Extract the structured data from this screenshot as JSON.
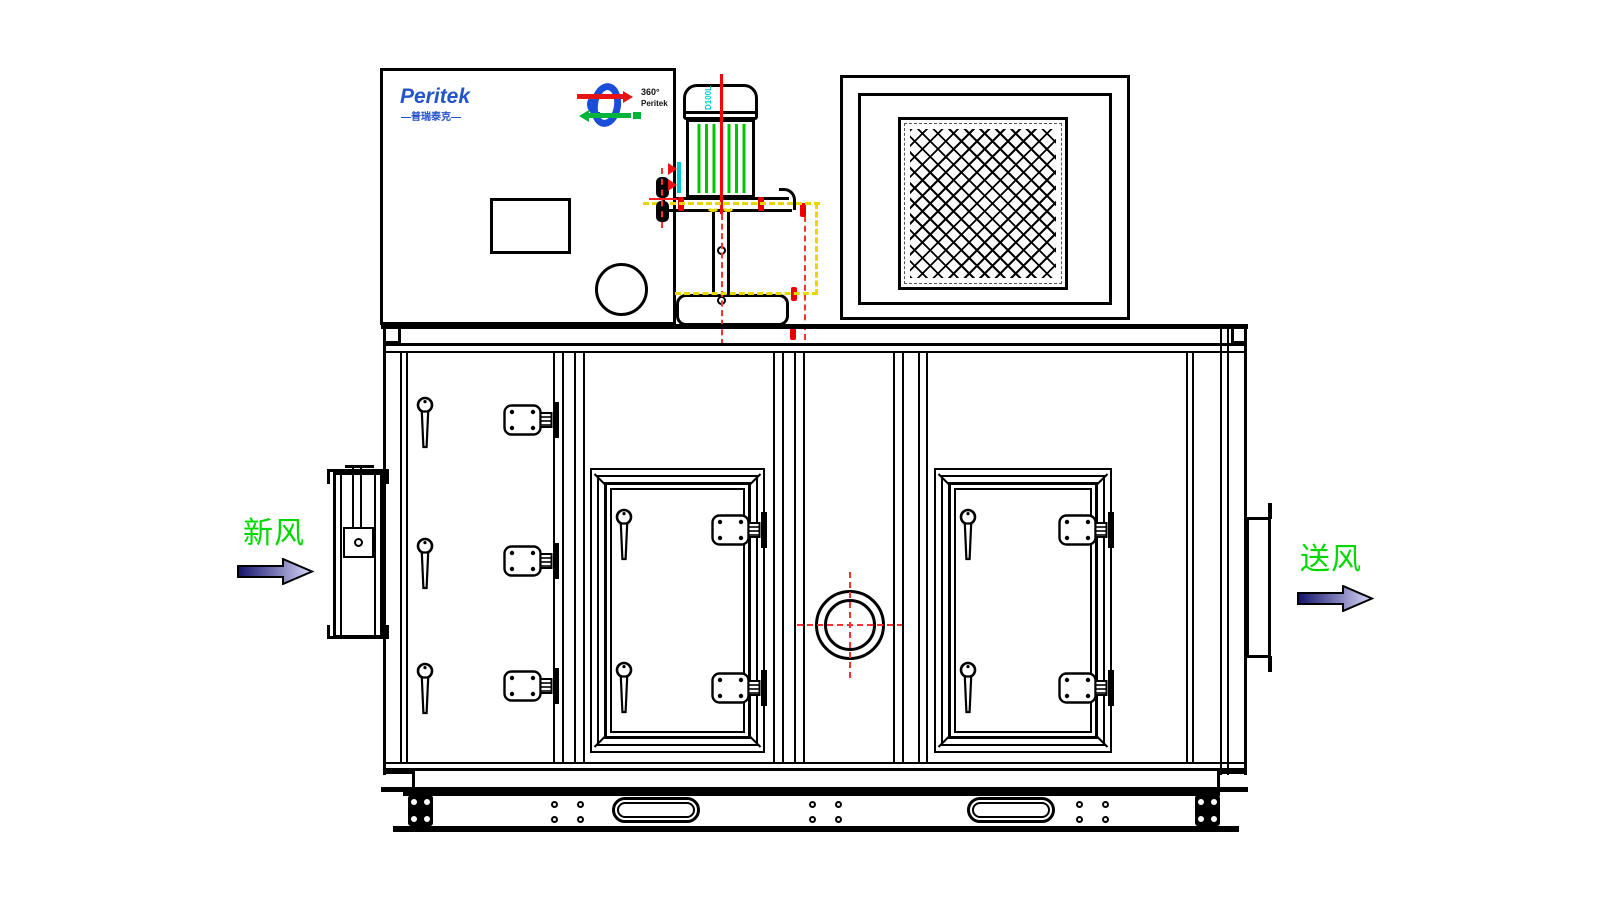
{
  "drawing": {
    "brand": {
      "name": "Peritek",
      "subtitle": "—普瑞泰克—",
      "brand_color": "#2553c8"
    },
    "rotor_logo": {
      "angle_text": "360°",
      "brand_text": "Peritek"
    },
    "motor": {
      "frame_size_label": "D100L",
      "fin_color": "#00c400",
      "label_color": "#00cccc"
    },
    "airflow": {
      "inlet_label": "新风",
      "outlet_label": "送风",
      "label_color": "#00d800",
      "arrow_dark": "#14126b",
      "arrow_light": "#d8d8fa"
    },
    "colors": {
      "line_black": "#000000",
      "centerline_red": "#ff2020",
      "highlight_yellow": "#e8d800",
      "accent_cyan": "#00cccc"
    }
  }
}
